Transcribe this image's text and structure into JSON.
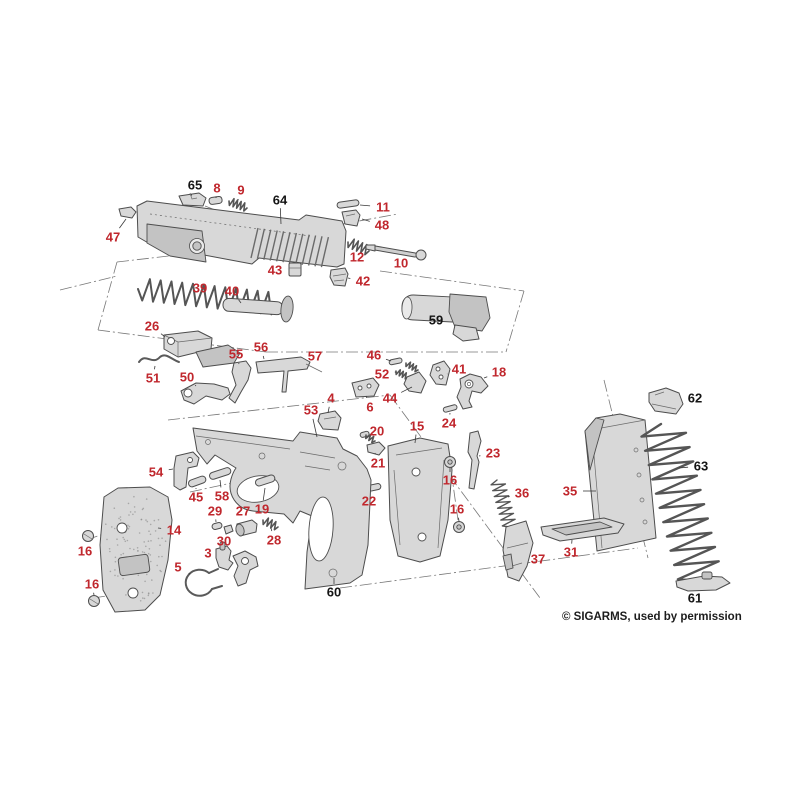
{
  "meta": {
    "credit": "© SIGARMS, used by permission"
  },
  "diagram": {
    "description": "Exploded parts diagram of a SIGARMS pistol with numbered callouts",
    "colors": {
      "red": "#c0272d",
      "black": "#141414",
      "part_fill": "#d8d8d8",
      "part_stroke": "#4d4d4d",
      "background": "#ffffff"
    },
    "labels": [
      {
        "text": "47",
        "x": 113,
        "y": 237,
        "color": "red",
        "tx": 126,
        "ty": 219
      },
      {
        "text": "65",
        "x": 195,
        "y": 185,
        "color": "black",
        "tx": 191,
        "ty": 196
      },
      {
        "text": "8",
        "x": 217,
        "y": 188,
        "color": "red",
        "tx": 216,
        "ty": 198
      },
      {
        "text": "9",
        "x": 241,
        "y": 190,
        "color": "red",
        "tx": 238,
        "ty": 200
      },
      {
        "text": "64",
        "x": 280,
        "y": 200,
        "color": "black",
        "tx": 281,
        "ty": 224
      },
      {
        "text": "11",
        "x": 383,
        "y": 207,
        "color": "red",
        "tx": 360,
        "ty": 205
      },
      {
        "text": "48",
        "x": 382,
        "y": 225,
        "color": "red",
        "tx": 362,
        "ty": 219
      },
      {
        "text": "12",
        "x": 357,
        "y": 257,
        "color": "red",
        "tx": 357,
        "ty": 249
      },
      {
        "text": "10",
        "x": 401,
        "y": 263,
        "color": "red",
        "tx": 398,
        "ty": 256
      },
      {
        "text": "43",
        "x": 275,
        "y": 270,
        "color": "red",
        "tx": 288,
        "ty": 269
      },
      {
        "text": "42",
        "x": 363,
        "y": 281,
        "color": "red",
        "tx": 348,
        "ty": 278
      },
      {
        "text": "39",
        "x": 200,
        "y": 288,
        "color": "red",
        "tx": 205,
        "ty": 296
      },
      {
        "text": "40",
        "x": 232,
        "y": 291,
        "color": "red",
        "tx": 241,
        "ty": 303
      },
      {
        "text": "59",
        "x": 436,
        "y": 320,
        "color": "black",
        "tx": 433,
        "ty": 311
      },
      {
        "text": "26",
        "x": 152,
        "y": 326,
        "color": "red",
        "tx": 165,
        "ty": 337
      },
      {
        "text": "56",
        "x": 261,
        "y": 347,
        "color": "red",
        "tx": 264,
        "ty": 359
      },
      {
        "text": "55",
        "x": 236,
        "y": 354,
        "color": "red",
        "tx": 239,
        "ty": 364
      },
      {
        "text": "57",
        "x": 315,
        "y": 356,
        "color": "red",
        "tx": 311,
        "ty": 365
      },
      {
        "text": "46",
        "x": 374,
        "y": 355,
        "color": "red",
        "tx": 391,
        "ty": 361
      },
      {
        "text": "52",
        "x": 382,
        "y": 374,
        "color": "red",
        "tx": 396,
        "ty": 372
      },
      {
        "text": "41",
        "x": 459,
        "y": 369,
        "color": "red",
        "tx": 447,
        "ty": 374
      },
      {
        "text": "18",
        "x": 499,
        "y": 372,
        "color": "red",
        "tx": 484,
        "ty": 378
      },
      {
        "text": "51",
        "x": 153,
        "y": 378,
        "color": "red",
        "tx": 155,
        "ty": 366
      },
      {
        "text": "50",
        "x": 187,
        "y": 377,
        "color": "red",
        "tx": 196,
        "ty": 386
      },
      {
        "text": "4",
        "x": 331,
        "y": 398,
        "color": "red",
        "tx": 328,
        "ty": 413
      },
      {
        "text": "44",
        "x": 390,
        "y": 398,
        "color": "red",
        "tx": 412,
        "ty": 387
      },
      {
        "text": "6",
        "x": 370,
        "y": 407,
        "color": "red",
        "tx": 366,
        "ty": 396
      },
      {
        "text": "53",
        "x": 311,
        "y": 410,
        "color": "red",
        "tx": 317,
        "ty": 437
      },
      {
        "text": "24",
        "x": 449,
        "y": 423,
        "color": "red",
        "tx": 450,
        "ty": 413
      },
      {
        "text": "15",
        "x": 417,
        "y": 426,
        "color": "red",
        "tx": 415,
        "ty": 443
      },
      {
        "text": "20",
        "x": 377,
        "y": 431,
        "color": "red",
        "tx": 369,
        "ty": 437
      },
      {
        "text": "21",
        "x": 378,
        "y": 463,
        "color": "red",
        "tx": 375,
        "ty": 453
      },
      {
        "text": "23",
        "x": 493,
        "y": 453,
        "color": "red",
        "tx": 479,
        "ty": 456
      },
      {
        "text": "16",
        "x": 450,
        "y": 480,
        "color": "red",
        "tx": 450,
        "ty": 468
      },
      {
        "text": "22",
        "x": 369,
        "y": 501,
        "color": "red",
        "tx": 371,
        "ty": 492
      },
      {
        "text": "16",
        "x": 457,
        "y": 509,
        "color": "red",
        "tx": 459,
        "ty": 521
      },
      {
        "text": "36",
        "x": 522,
        "y": 493,
        "color": "red",
        "tx": 508,
        "ty": 497
      },
      {
        "text": "35",
        "x": 570,
        "y": 491,
        "color": "red",
        "tx": 596,
        "ty": 491
      },
      {
        "text": "54",
        "x": 156,
        "y": 472,
        "color": "red",
        "tx": 173,
        "ty": 469
      },
      {
        "text": "45",
        "x": 196,
        "y": 497,
        "color": "red",
        "tx": 196,
        "ty": 488
      },
      {
        "text": "58",
        "x": 222,
        "y": 496,
        "color": "red",
        "tx": 220,
        "ty": 480
      },
      {
        "text": "19",
        "x": 262,
        "y": 509,
        "color": "red",
        "tx": 265,
        "ty": 488
      },
      {
        "text": "29",
        "x": 215,
        "y": 511,
        "color": "red",
        "tx": 216,
        "ty": 522
      },
      {
        "text": "27",
        "x": 243,
        "y": 511,
        "color": "red",
        "tx": 246,
        "ty": 520
      },
      {
        "text": "14",
        "x": 174,
        "y": 530,
        "color": "red",
        "tx": 158,
        "ty": 528
      },
      {
        "text": "30",
        "x": 224,
        "y": 541,
        "color": "red",
        "tx": 227,
        "ty": 533
      },
      {
        "text": "28",
        "x": 274,
        "y": 540,
        "color": "red",
        "tx": 271,
        "ty": 528
      },
      {
        "text": "16",
        "x": 85,
        "y": 551,
        "color": "red",
        "tx": 88,
        "ty": 542
      },
      {
        "text": "16",
        "x": 92,
        "y": 584,
        "color": "red",
        "tx": 94,
        "ty": 595
      },
      {
        "text": "3",
        "x": 208,
        "y": 553,
        "color": "red",
        "tx": 218,
        "ty": 552
      },
      {
        "text": "5",
        "x": 178,
        "y": 567,
        "color": "red",
        "tx": 190,
        "ty": 574
      },
      {
        "text": "31",
        "x": 571,
        "y": 552,
        "color": "red",
        "tx": 572,
        "ty": 540
      },
      {
        "text": "37",
        "x": 538,
        "y": 559,
        "color": "red",
        "tx": 527,
        "ty": 556
      },
      {
        "text": "60",
        "x": 334,
        "y": 592,
        "color": "black",
        "tx": 334,
        "ty": 578
      },
      {
        "text": "62",
        "x": 695,
        "y": 398,
        "color": "black",
        "tx": 684,
        "ty": 399
      },
      {
        "text": "63",
        "x": 701,
        "y": 466,
        "color": "black",
        "tx": 679,
        "ty": 468
      },
      {
        "text": "61",
        "x": 695,
        "y": 598,
        "color": "black",
        "tx": 697,
        "ty": 590
      }
    ]
  }
}
